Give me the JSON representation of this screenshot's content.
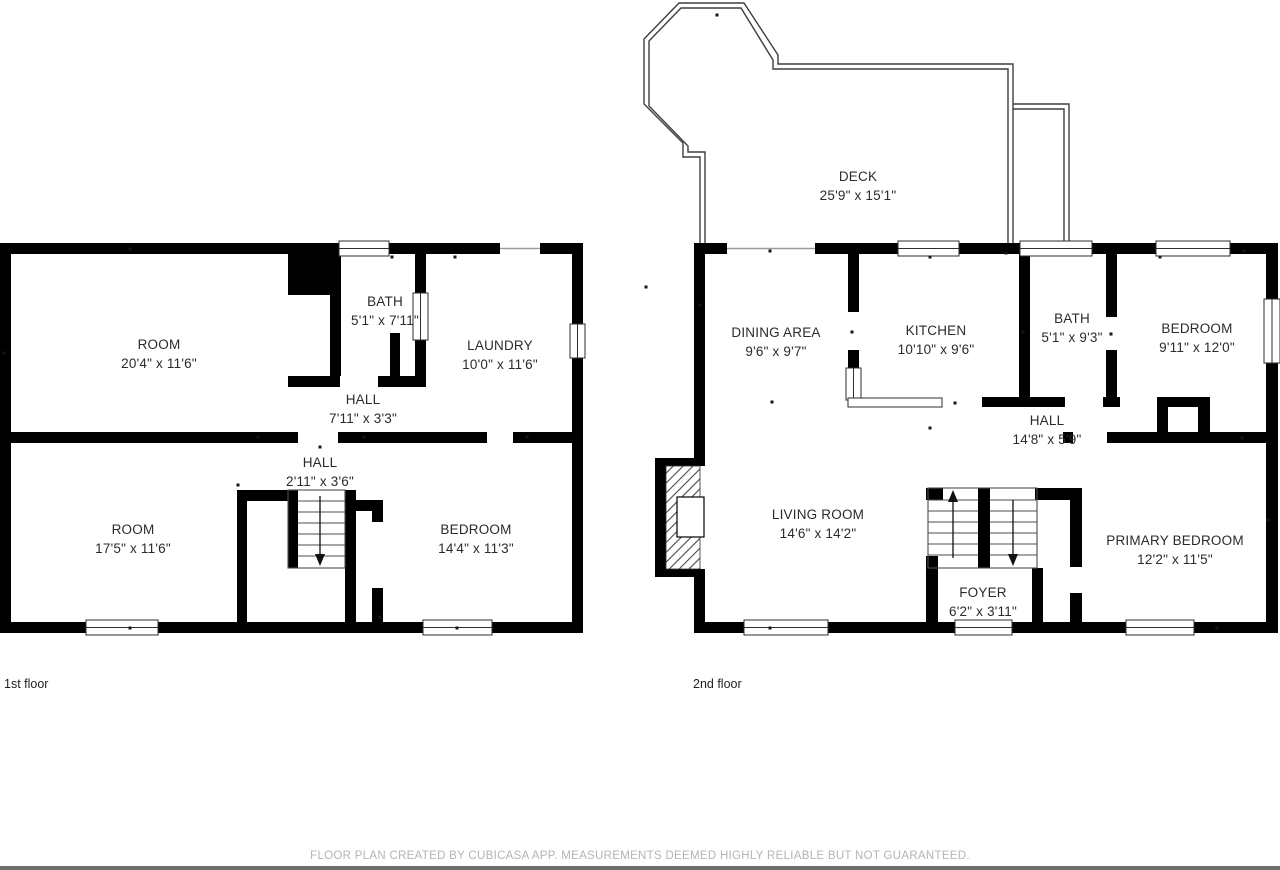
{
  "footer": {
    "disclaimer": "FLOOR PLAN CREATED BY CUBICASA APP. MEASUREMENTS DEEMED HIGHLY RELIABLE BUT NOT GUARANTEED."
  },
  "colors": {
    "wall": "#000000",
    "label_text": "#2b2b2b",
    "deck_outline": "#3f3f3f",
    "footer_text": "#b4b4b4",
    "background": "#ffffff"
  },
  "floors": [
    {
      "caption": "1st floor",
      "rooms": [
        {
          "name": "ROOM",
          "dims": "20'4\" x 11'6\""
        },
        {
          "name": "BATH",
          "dims": "5'1\" x 7'11\""
        },
        {
          "name": "LAUNDRY",
          "dims": "10'0\" x 11'6\""
        },
        {
          "name": "HALL",
          "dims": "7'11\" x 3'3\""
        },
        {
          "name": "HALL",
          "dims": "2'11\" x 3'6\""
        },
        {
          "name": "ROOM",
          "dims": "17'5\" x 11'6\""
        },
        {
          "name": "BEDROOM",
          "dims": "14'4\" x 11'3\""
        }
      ]
    },
    {
      "caption": "2nd floor",
      "rooms": [
        {
          "name": "DECK",
          "dims": "25'9\" x 15'1\""
        },
        {
          "name": "DINING AREA",
          "dims": "9'6\" x 9'7\""
        },
        {
          "name": "KITCHEN",
          "dims": "10'10\" x 9'6\""
        },
        {
          "name": "BATH",
          "dims": "5'1\" x 9'3\""
        },
        {
          "name": "BEDROOM",
          "dims": "9'11\" x 12'0\""
        },
        {
          "name": "HALL",
          "dims": "14'8\" x 5'9\""
        },
        {
          "name": "LIVING ROOM",
          "dims": "14'6\" x 14'2\""
        },
        {
          "name": "PRIMARY BEDROOM",
          "dims": "12'2\" x 11'5\""
        },
        {
          "name": "FOYER",
          "dims": "6'2\" x 3'11\""
        }
      ]
    }
  ]
}
